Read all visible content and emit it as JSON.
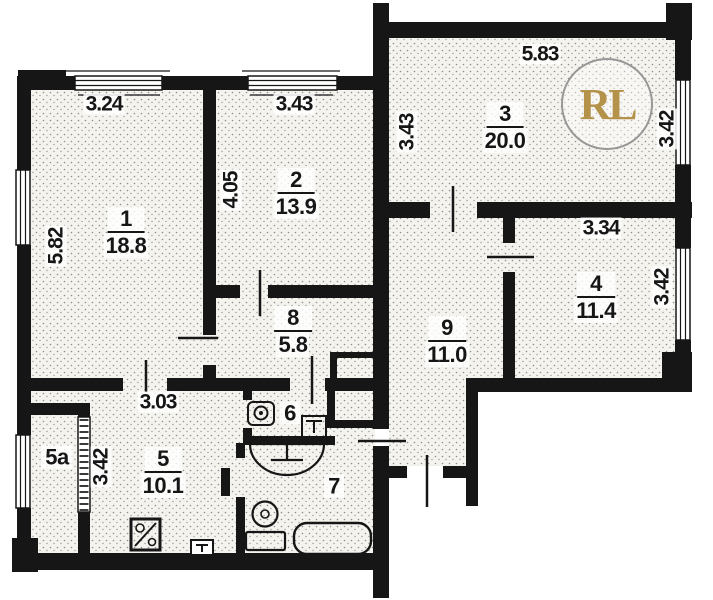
{
  "floorplan": {
    "watermark": "RL",
    "rooms": {
      "1": {
        "number": "1",
        "area": "18.8"
      },
      "2": {
        "number": "2",
        "area": "13.9"
      },
      "3": {
        "number": "3",
        "area": "20.0"
      },
      "4": {
        "number": "4",
        "area": "11.4"
      },
      "5": {
        "number": "5",
        "area": "10.1"
      },
      "5a": {
        "number": "5a"
      },
      "6": {
        "number": "6"
      },
      "7": {
        "number": "7"
      },
      "8": {
        "number": "8",
        "area": "5.8"
      },
      "9": {
        "number": "9",
        "area": "11.0"
      }
    },
    "dimensions": {
      "room1_width": "3.24",
      "room1_depth": "5.82",
      "room2_width": "3.43",
      "room2_depth": "4.05",
      "room3_width": "5.83",
      "room3_depth": "3.43",
      "room3_right": "3.42",
      "room4_width": "3.34",
      "room4_right": "3.42",
      "hall_width": "3.03",
      "room5_left": "3.42"
    },
    "colors": {
      "walls": "#161616",
      "room_fill": "#f5f3ee",
      "stipple_dots": "#8d8d8d",
      "watermark_text": "#b5924a",
      "watermark_ring": "#979797"
    }
  }
}
